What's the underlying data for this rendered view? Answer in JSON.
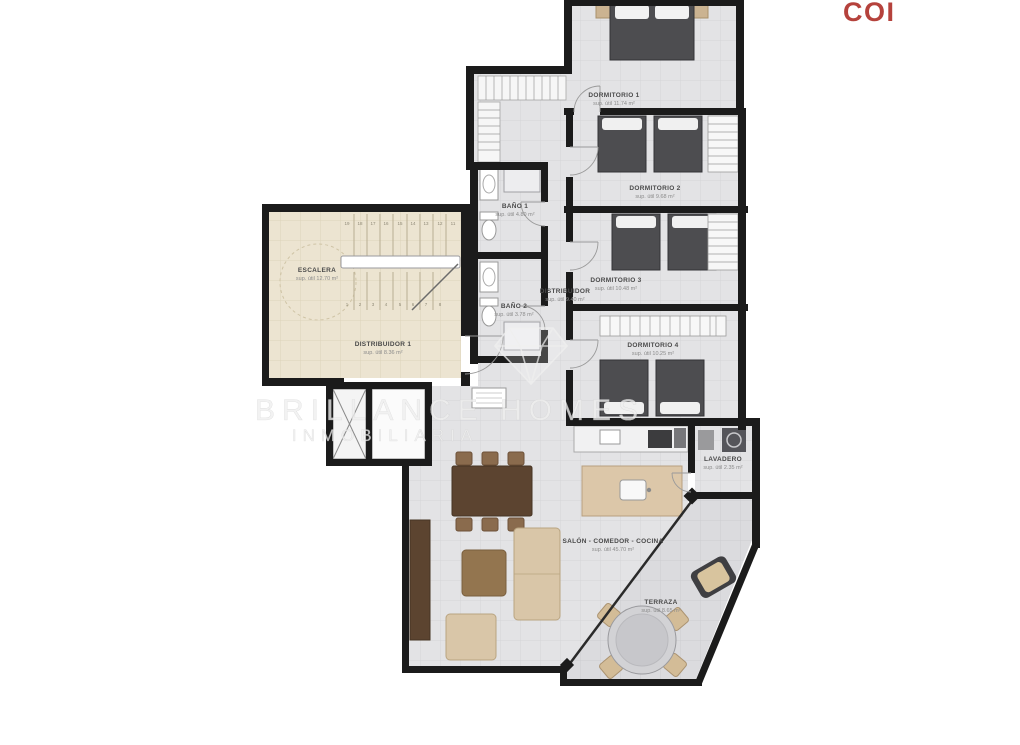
{
  "brand": {
    "logo_text": "COI",
    "logo_color": "#b5423c"
  },
  "watermark": {
    "title": "BRILLANCE HOMES",
    "subtitle": "INMOBILIARIA",
    "icon": "diamond-gem-icon"
  },
  "plan": {
    "rooms": {
      "dormitorio_1": {
        "label": "DORMITORIO 1",
        "area": "sup. útil 11.74 m²"
      },
      "dormitorio_2": {
        "label": "DORMITORIO 2",
        "area": "sup. útil 9.68 m²"
      },
      "dormitorio_3": {
        "label": "DORMITORIO 3",
        "area": "sup. útil 10.48 m²"
      },
      "dormitorio_4": {
        "label": "DORMITORIO 4",
        "area": "sup. útil 10.25 m²"
      },
      "bano_1": {
        "label": "BAÑO 1",
        "area": "sup. útil 4.80 m²"
      },
      "bano_2": {
        "label": "BAÑO 2",
        "area": "sup. útil 3.78 m²"
      },
      "distribuidor": {
        "label": "DISTRIBUIDOR",
        "area": "sup. útil 9.40 m²"
      },
      "escalera": {
        "label": "ESCALERA",
        "area": "sup. útil 12.70 m²"
      },
      "distribuidor_1": {
        "label": "DISTRIBUIDOR 1",
        "area": "sup. útil 8.36 m²"
      },
      "lavadero": {
        "label": "LAVADERO",
        "area": "sup. útil 2.35 m²"
      },
      "salon": {
        "label": "SALÓN - COMEDOR - COCINA",
        "area": "sup. útil 45.70 m²"
      },
      "terraza": {
        "label": "TERRAZA",
        "area": "sup. útil 8.65 m²"
      }
    },
    "stairs": {
      "treads_up": [
        "19",
        "18",
        "17",
        "16",
        "15",
        "14",
        "13",
        "12",
        "11"
      ],
      "treads_down": [
        "1",
        "2",
        "3",
        "4",
        "5",
        "6",
        "7",
        "8"
      ]
    },
    "colors": {
      "wall": "#1b1b1b",
      "floor": "#e3e3e5",
      "common_floor": "#ece4d1",
      "terrace_floor": "#dbdbde",
      "wood": "#dcc7a9",
      "dark_furniture": "#4d4d50",
      "accent_red": "#b5423c"
    }
  }
}
